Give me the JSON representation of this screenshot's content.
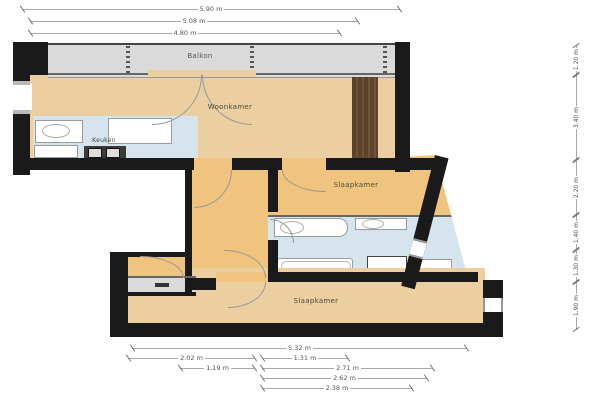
{
  "page_title": "Plattegrond",
  "colors": {
    "wall": "#1a1a1a",
    "room_tan": "#eccfa0",
    "hall_tan": "#f0c47e",
    "wet_blue": "#d5e4ed",
    "balcony_gray": "#dadada",
    "shaft_brown": "#5d432c",
    "dim_text": "#555555"
  },
  "rooms": {
    "balcony": {
      "label": "Balkon"
    },
    "living": {
      "label": "Woonkamer"
    },
    "kitchen": {
      "label": "Keuken"
    },
    "bedroom_mid": {
      "label": "Slaapkamer"
    },
    "bedroom_bottom": {
      "label": "Slaapkamer"
    }
  },
  "dimensions": {
    "top": [
      {
        "label": "5.90 m"
      },
      {
        "label": "5.08 m"
      },
      {
        "label": "4.80 m"
      }
    ],
    "bottom": [
      {
        "label": "5.32 m"
      },
      {
        "label": "2.02 m"
      },
      {
        "label": "1.31 m"
      },
      {
        "label": "1.19 m"
      },
      {
        "label": "2.71 m"
      },
      {
        "label": "2.62 m"
      },
      {
        "label": "2.38 m"
      }
    ],
    "right": [
      {
        "label": "1.20 m"
      },
      {
        "label": "3.40 m"
      },
      {
        "label": "2.20 m"
      },
      {
        "label": "1.40 m"
      },
      {
        "label": "1.30 m"
      },
      {
        "label": "1.90 m"
      }
    ]
  }
}
